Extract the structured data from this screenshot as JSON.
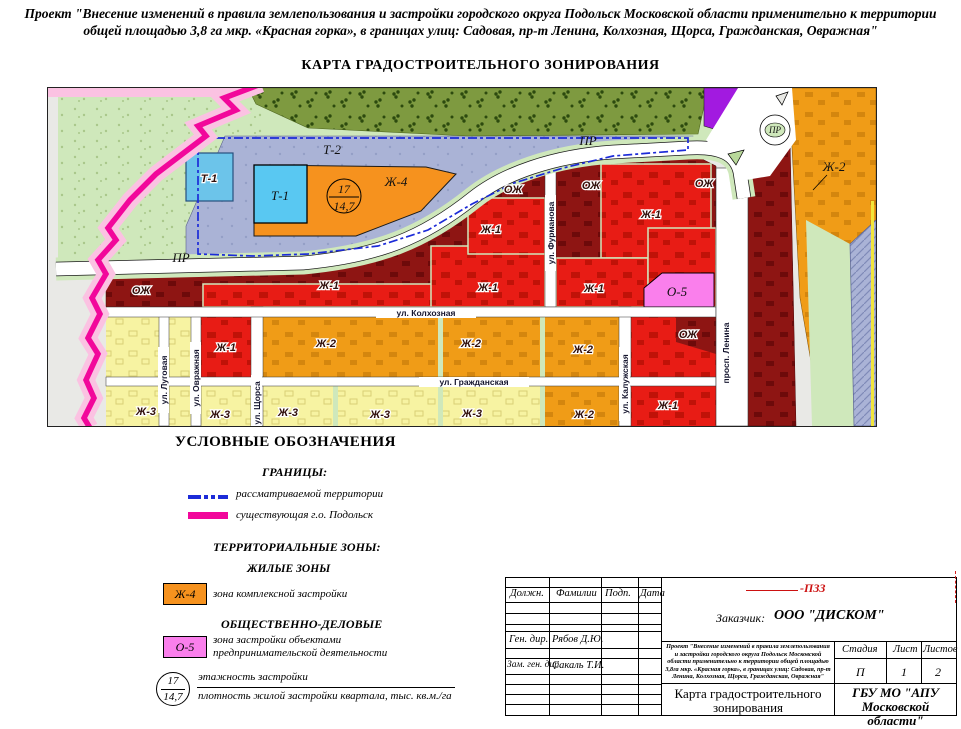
{
  "header": {
    "line1": "Проект \"Внесение изменений в правила землепользования и застройки городского округа Подольск  Московской области применительно к территории",
    "line2": "общей площадью 3,8 га  мкр. «Красная горка», в границах улиц: Садовая, пр-т Ленина, Колхозная, Щорса, Гражданская, Овражная\"",
    "map_title": "КАРТА ГРАДОСТРОИТЕЛЬНОГО ЗОНИРОВАНИЯ"
  },
  "map": {
    "codes": {
      "t1": "Т-1",
      "t2": "Т-2",
      "zh1": "Ж-1",
      "zh2": "Ж-2",
      "zh3": "Ж-3",
      "zh4": "Ж-4",
      "ozh": "ОЖ",
      "o5": "О-5",
      "pr": "ПР"
    },
    "streets": {
      "furmanova": "ул. Фурманова",
      "kolkhoznaya": "ул. Колхозная",
      "grazhdanskaya": "ул. Гражданская",
      "lugovaya": "ул. Луговая",
      "ovrazhnaya": "ул. Овражная",
      "shchorsa": "ул. Щорса",
      "kaluzhskaya": "ул. Калужская",
      "lenina": "просп. Ленина"
    },
    "density": {
      "floors": "17",
      "value": "14,7"
    },
    "colors": {
      "zh1_red": "#e81c15",
      "zh2_orange": "#f09c17",
      "zh3_yellow": "#f7f3a2",
      "zh4_orange": "#f6921e",
      "ozh_maroon": "#8e1513",
      "o5_pink": "#fa7fec",
      "t1_blue": "#59c8f2",
      "t2_lavender": "#aab3d6",
      "purple": "#a21ae0",
      "olive": "#7e9a40",
      "green": "#cfe8bb",
      "border_pink": "#fbc2e2",
      "border_magenta": "#f2079b",
      "territory_blue": "#1c2bd8"
    }
  },
  "legend": {
    "title": "УСЛОВНЫЕ ОБОЗНАЧЕНИЯ",
    "borders_heading": "ГРАНИЦЫ:",
    "border1": "рассматриваемой территории",
    "border2": "существующая г.о. Подольск",
    "zones_heading": "ТЕРРИТОРИАЛЬНЫЕ ЗОНЫ:",
    "residential_heading": "ЖИЛЫЕ ЗОНЫ",
    "zh4_code": "Ж-4",
    "zh4_label": "зона комплексной застройки",
    "business_heading": "ОБЩЕСТВЕННО-ДЕЛОВЫЕ",
    "o5_code": "О-5",
    "o5_label1": "зона застройки объектами",
    "o5_label2": "предпринимательской деятельности",
    "floors": "17",
    "density": "14,7",
    "floors_label": "этажность застройки",
    "density_label": "плотность жилой застройки квартала, тыс. кв.м./га"
  },
  "stamp": {
    "code": "-ПЗЗ",
    "col1": "Должн.",
    "col2": "Фамилии",
    "col3": "Подп.",
    "col4": "Дата",
    "customer_label": "Заказчик:",
    "customer_name": "ООО \"ДИСКОМ\"",
    "row1_role": "Ген. дир.",
    "row1_name": "Рябов Д.Ю.",
    "row2_role": "Зам. ген. дир.",
    "row2_name": "Сакаль Т.И.",
    "project": "Проект \"Внесение изменений в правила землепользования и застройки городского округа Подольск  Московской области применительно к территории общей площадью 3,8га  мкр. «Красная горка», в границах улиц: Садовая, пр-т Ленина, Колхозная, Щорса, Гражданская, Овражная\"",
    "stage_h": "Стадия",
    "sheet_h": "Лист",
    "sheets_h": "Листов",
    "stage_v": "П",
    "sheet_v": "1",
    "sheets_v": "2",
    "doc_title": "Карта градостроительного зонирования",
    "org1": "ГБУ МО \"АПУ",
    "org2": "Московской области\""
  }
}
